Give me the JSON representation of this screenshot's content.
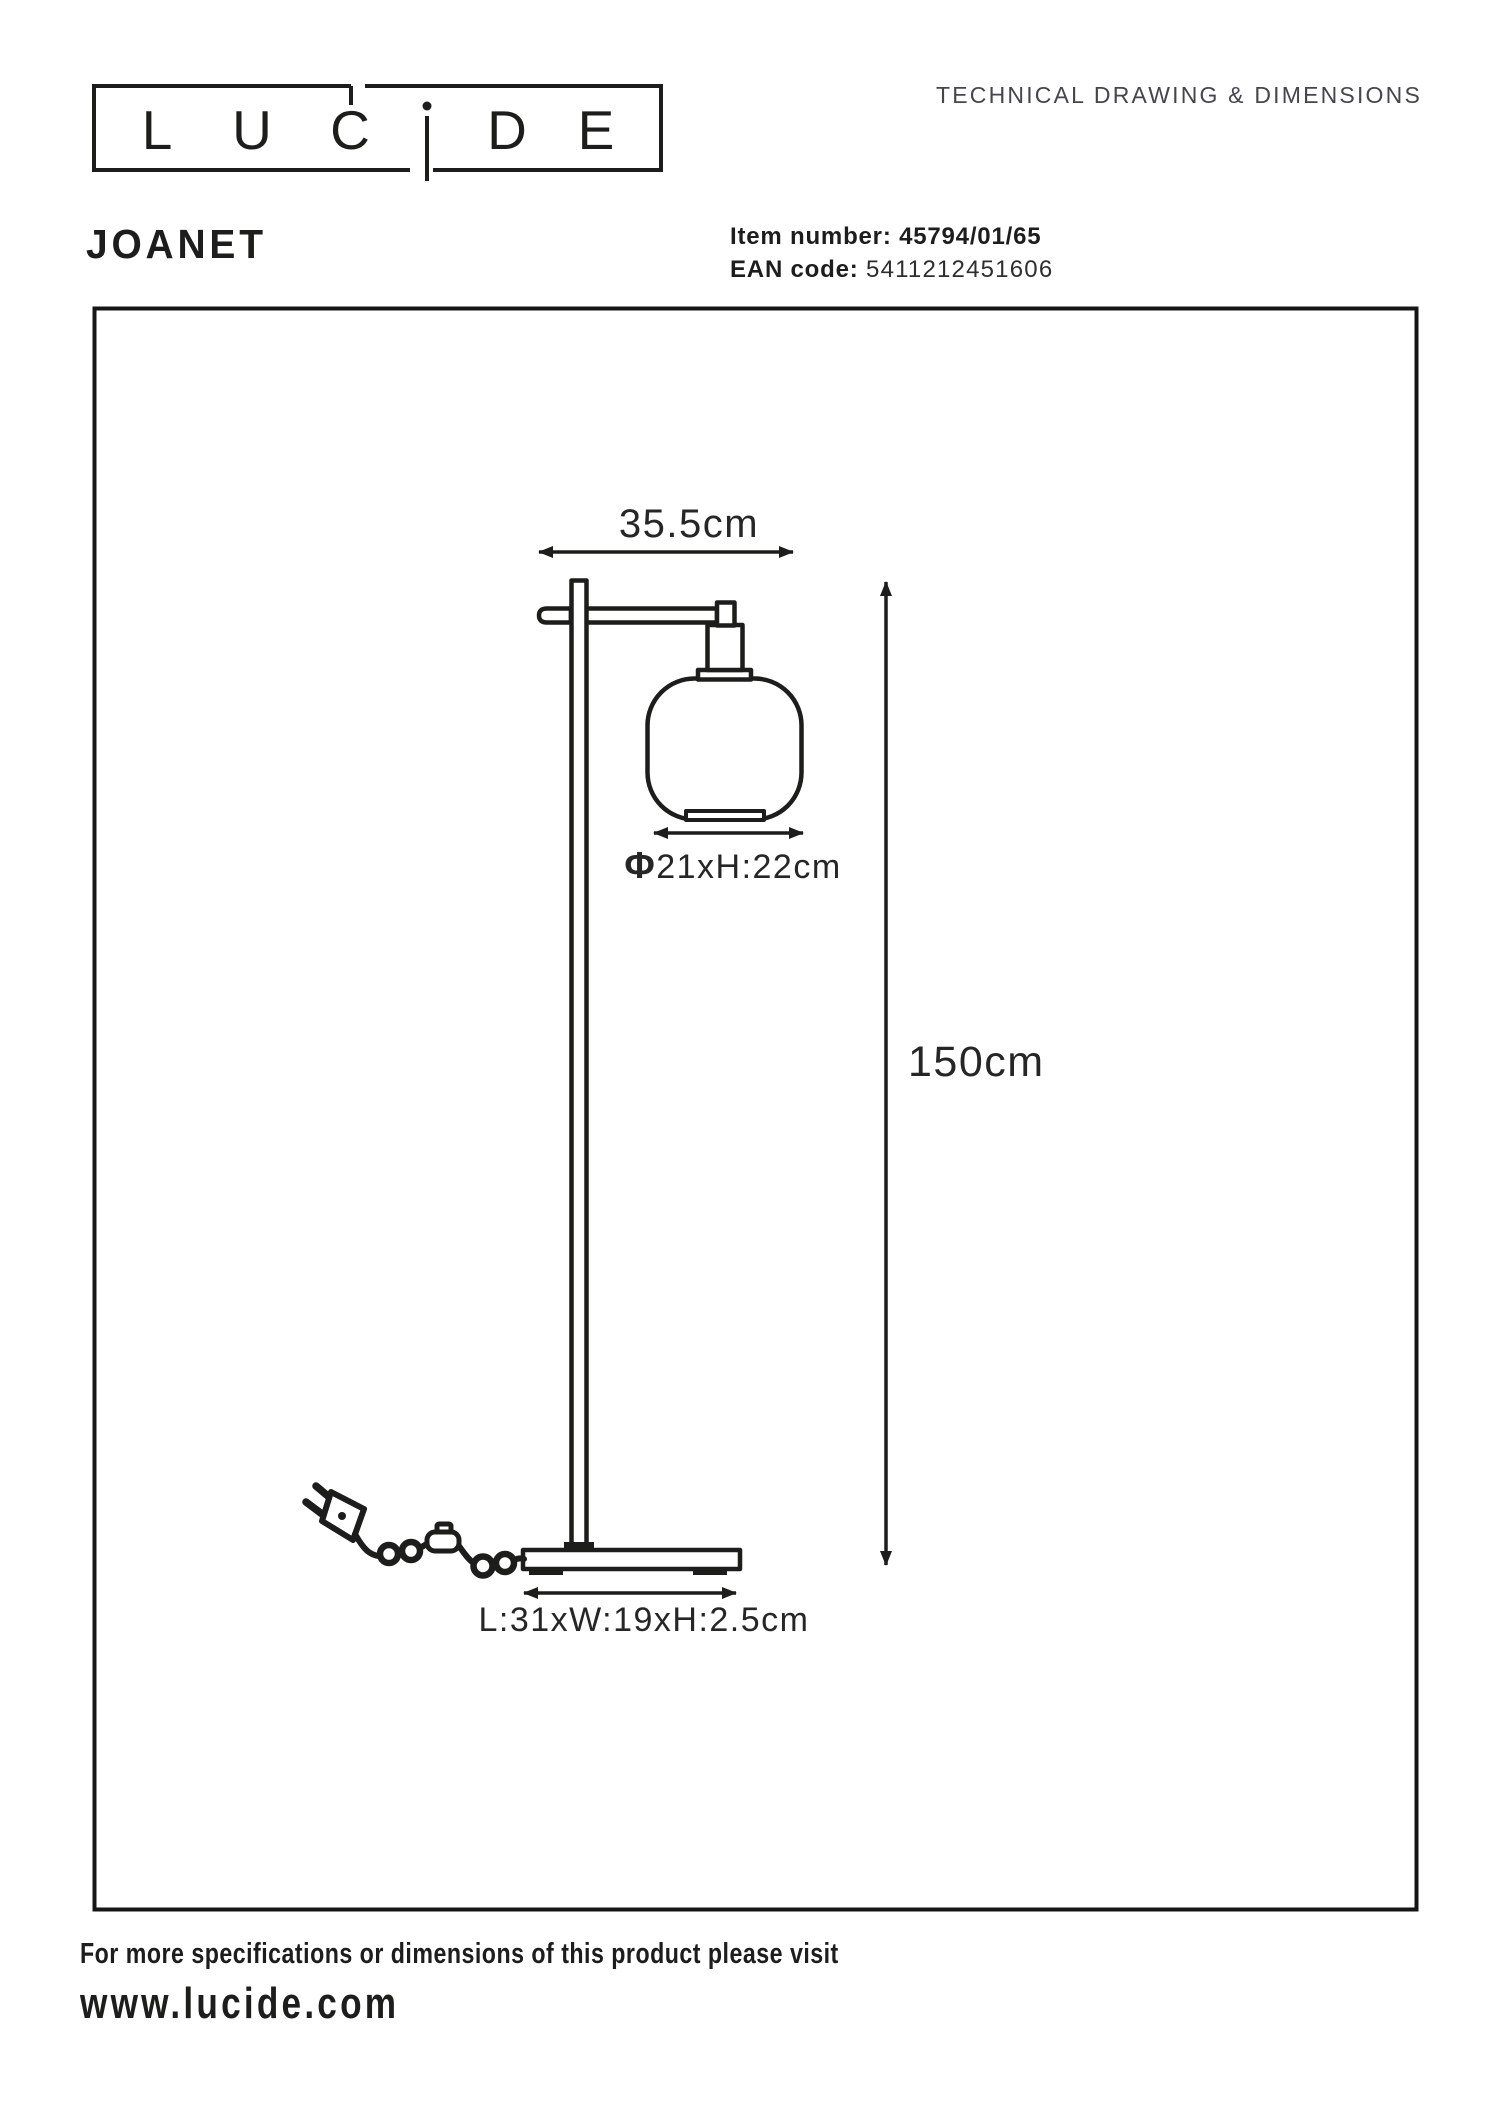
{
  "logo": {
    "letters": [
      "L",
      "U",
      "C",
      "D",
      "E"
    ]
  },
  "header": {
    "doc_type": "TECHNICAL DRAWING & DIMENSIONS"
  },
  "product": {
    "name": "JOANET",
    "item_label": "Item number:",
    "item_number": "45794/01/65",
    "ean_label": "EAN code:",
    "ean_code": "5411212451606"
  },
  "drawing": {
    "width_label": "35.5cm",
    "shade_symbol": "Φ",
    "shade_label": "21xH:22cm",
    "height_label": "150cm",
    "base_label": "L:31xW:19xH:2.5cm"
  },
  "footer": {
    "note": "For more specifications or dimensions of this product please visit",
    "website": "www.lucide.com"
  },
  "colors": {
    "ink": "#1d1d1b",
    "muted": "#45454d"
  }
}
